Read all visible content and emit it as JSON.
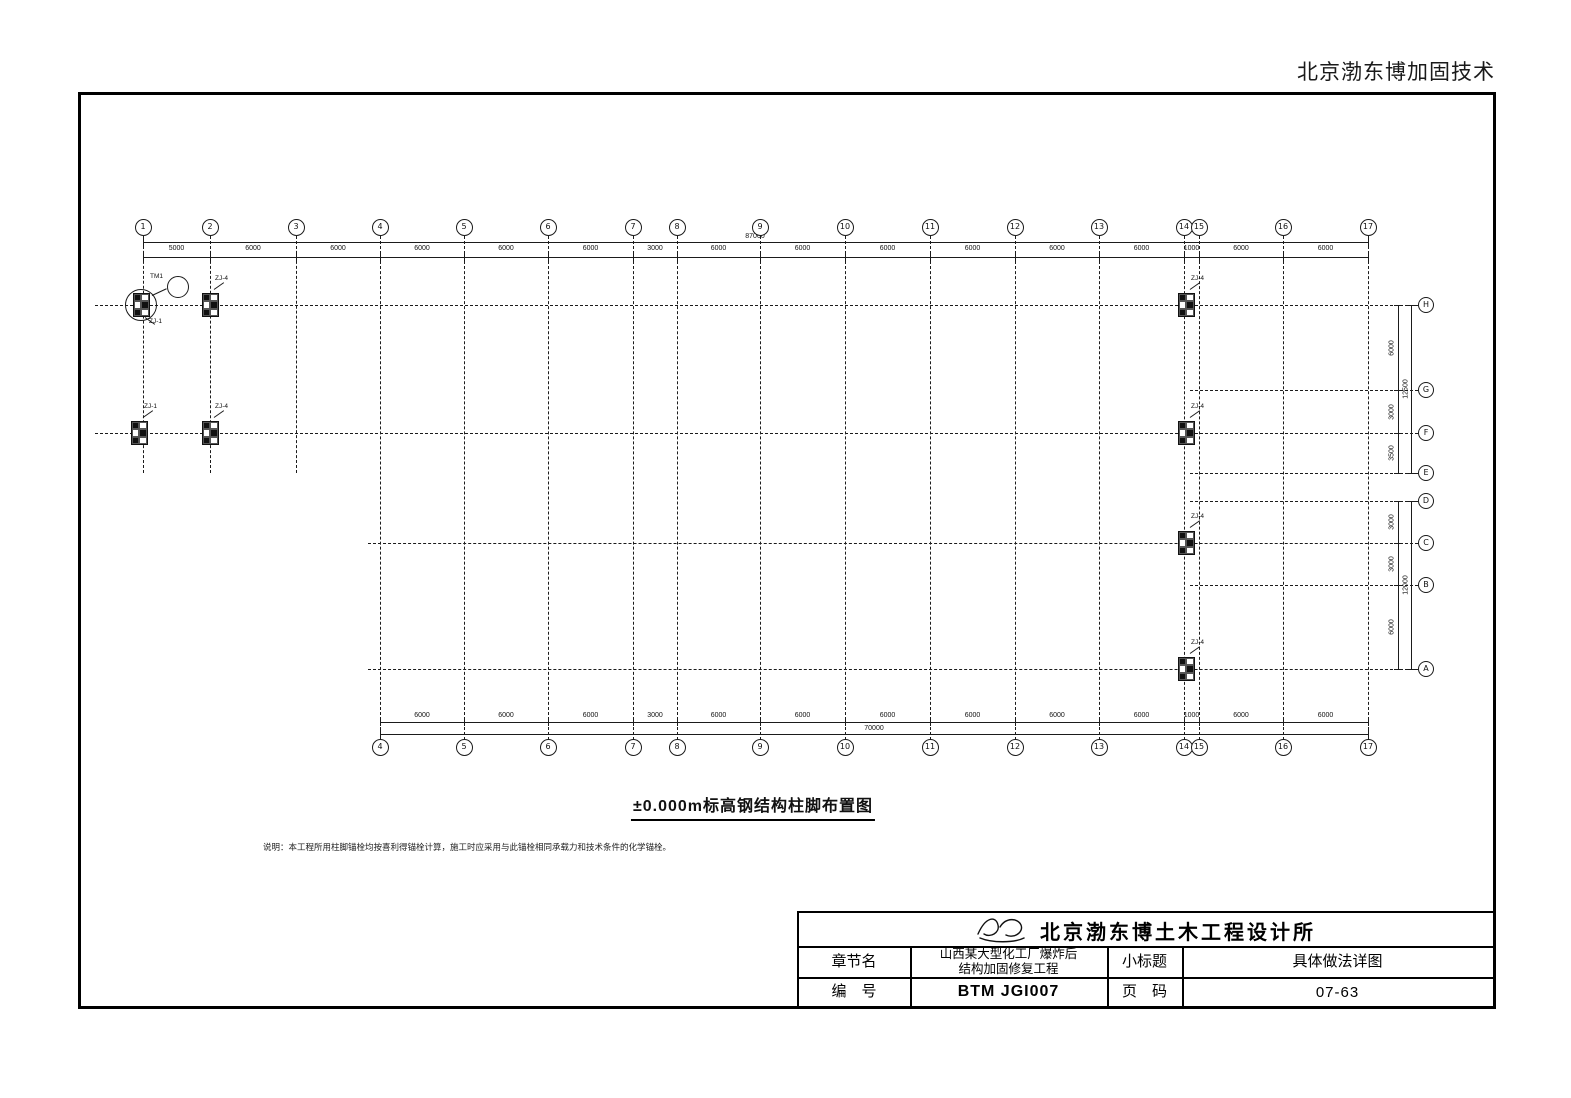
{
  "page": {
    "brand_header": "北京渤东博加固技术"
  },
  "drawing": {
    "title": "±0.000m标高钢结构柱脚布置图",
    "note": "说明：本工程所用柱脚锚栓均按喜利得锚栓计算，施工时应采用与此锚栓相同承载力和技术条件的化学锚栓。",
    "grid": {
      "columns": [
        {
          "label": "1",
          "x": 143
        },
        {
          "label": "2",
          "x": 210
        },
        {
          "label": "3",
          "x": 296
        },
        {
          "label": "4",
          "x": 380
        },
        {
          "label": "5",
          "x": 464
        },
        {
          "label": "6",
          "x": 548
        },
        {
          "label": "7",
          "x": 633
        },
        {
          "label": "8",
          "x": 677
        },
        {
          "label": "9",
          "x": 760
        },
        {
          "label": "10",
          "x": 845
        },
        {
          "label": "11",
          "x": 930
        },
        {
          "label": "12",
          "x": 1015
        },
        {
          "label": "13",
          "x": 1099
        },
        {
          "label": "14",
          "x": 1184
        },
        {
          "label": "15",
          "x": 1199
        },
        {
          "label": "16",
          "x": 1283
        },
        {
          "label": "17",
          "x": 1368
        }
      ],
      "short_top_columns": [
        "1",
        "2",
        "3"
      ],
      "rows": [
        {
          "label": "H",
          "y": 305,
          "span": "full"
        },
        {
          "label": "G",
          "y": 390,
          "span": "right"
        },
        {
          "label": "F",
          "y": 433,
          "span": "full"
        },
        {
          "label": "E",
          "y": 473,
          "span": "right"
        },
        {
          "label": "D",
          "y": 501,
          "span": "right"
        },
        {
          "label": "C",
          "y": 543,
          "span": "lower"
        },
        {
          "label": "B",
          "y": 585,
          "span": "right"
        },
        {
          "label": "A",
          "y": 669,
          "span": "lower"
        }
      ]
    },
    "top_dim": {
      "total": "87000",
      "segments": [
        "5000",
        "6000",
        "6000",
        "6000",
        "6000",
        "6000",
        "3000",
        "6000",
        "6000",
        "6000",
        "6000",
        "6000",
        "6000",
        "1000",
        "6000",
        "6000"
      ]
    },
    "bottom_dim": {
      "total": "70000",
      "start_column": "4",
      "segments": [
        "6000",
        "6000",
        "6000",
        "3000",
        "6000",
        "6000",
        "6000",
        "6000",
        "6000",
        "6000",
        "1000",
        "6000",
        "6000"
      ]
    },
    "right_dims": {
      "upper": {
        "total": "12500",
        "segments": [
          {
            "from": "H",
            "to": "G",
            "text": "6000"
          },
          {
            "from": "G",
            "to": "F",
            "text": "3000"
          },
          {
            "from": "F",
            "to": "E",
            "text": "3500"
          }
        ]
      },
      "lower": {
        "total": "12000",
        "segments": [
          {
            "from": "D",
            "to": "C",
            "text": "3000"
          },
          {
            "from": "C",
            "to": "B",
            "text": "3000"
          },
          {
            "from": "B",
            "to": "A",
            "text": "6000"
          }
        ]
      }
    },
    "plates": [
      {
        "x": 141,
        "y": 305,
        "label": "ZJ-1",
        "circled": true,
        "ldx": 8,
        "ldy": 14
      },
      {
        "x": 210,
        "y": 305,
        "label": "ZJ-4",
        "ldx": 5,
        "ldy": -29
      },
      {
        "x": 1186,
        "y": 305,
        "label": "ZJ-4",
        "ldx": 5,
        "ldy": -29
      },
      {
        "x": 139,
        "y": 433,
        "label": "ZJ-1",
        "ldx": 5,
        "ldy": -29
      },
      {
        "x": 210,
        "y": 433,
        "label": "ZJ-4",
        "ldx": 5,
        "ldy": -29
      },
      {
        "x": 1186,
        "y": 433,
        "label": "ZJ-4",
        "ldx": 5,
        "ldy": -29
      },
      {
        "x": 1186,
        "y": 543,
        "label": "ZJ-4",
        "ldx": 5,
        "ldy": -29
      },
      {
        "x": 1186,
        "y": 669,
        "label": "ZJ-4",
        "ldx": 5,
        "ldy": -29
      }
    ],
    "detail_callout": {
      "number": "1",
      "tag": "TM1",
      "x": 178,
      "y": 287,
      "r": 11
    }
  },
  "titleblock": {
    "company": "北京渤东博土木工程设计所",
    "logo_icon": "signature-logo",
    "labels": {
      "chapter": "章节名",
      "subtitle": "小标题",
      "number": "编　号",
      "page": "页　码"
    },
    "values": {
      "project_line1": "山西某大型化工厂爆炸后",
      "project_line2": "结构加固修复工程",
      "subtitle": "具体做法详图",
      "number": "BTM JGI007",
      "page": "07-63"
    }
  }
}
